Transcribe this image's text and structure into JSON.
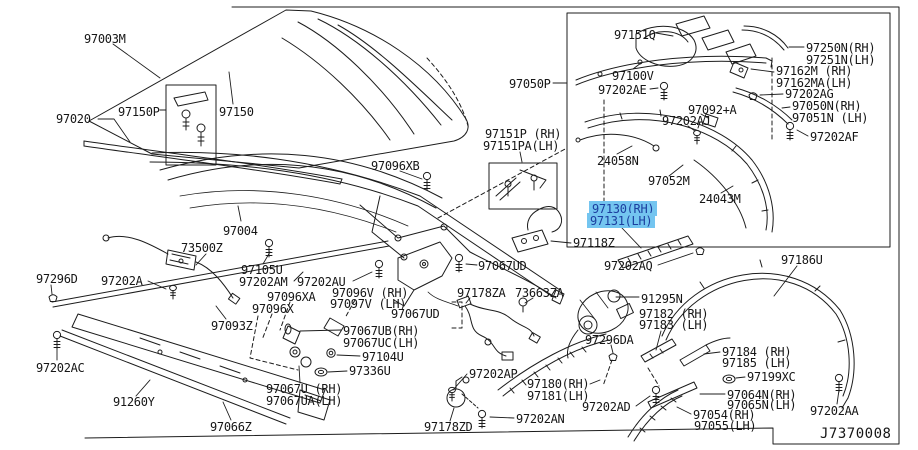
{
  "page": {
    "bg": "#ffffff",
    "line_color": "#1c1c1c",
    "highlight_bg": "#74c5f0",
    "highlight_text": "#1c3f9f",
    "diagram_code": "J7370008"
  },
  "labels": [
    {
      "text": "97003M",
      "x": 84,
      "y": 33
    },
    {
      "text": "97020",
      "x": 56,
      "y": 113
    },
    {
      "text": "97150P",
      "x": 118,
      "y": 106
    },
    {
      "text": "97150",
      "x": 219,
      "y": 106
    },
    {
      "text": "97096XB",
      "x": 371,
      "y": 160
    },
    {
      "text": "97050P",
      "x": 509,
      "y": 78
    },
    {
      "text": "97151P (RH)",
      "x": 485,
      "y": 128
    },
    {
      "text": "97151PA(LH)",
      "x": 483,
      "y": 140
    },
    {
      "text": "97004",
      "x": 223,
      "y": 225
    },
    {
      "text": "73500Z",
      "x": 181,
      "y": 242
    },
    {
      "text": "97105U",
      "x": 241,
      "y": 264
    },
    {
      "text": "97202AM",
      "x": 239,
      "y": 276
    },
    {
      "text": "97202AU",
      "x": 297,
      "y": 276
    },
    {
      "text": "97296D",
      "x": 36,
      "y": 273
    },
    {
      "text": "97202A",
      "x": 101,
      "y": 275
    },
    {
      "text": "97093Z",
      "x": 211,
      "y": 320
    },
    {
      "text": "97202AC",
      "x": 36,
      "y": 362
    },
    {
      "text": "91260Y",
      "x": 113,
      "y": 396
    },
    {
      "text": "97066Z",
      "x": 210,
      "y": 421
    },
    {
      "text": "97096XA",
      "x": 267,
      "y": 291
    },
    {
      "text": "97096X",
      "x": 252,
      "y": 303
    },
    {
      "text": "97096V (RH)",
      "x": 332,
      "y": 287
    },
    {
      "text": "97097V (LH)",
      "x": 330,
      "y": 298
    },
    {
      "text": "97067UD",
      "x": 478,
      "y": 260
    },
    {
      "text": "97067UD",
      "x": 391,
      "y": 308
    },
    {
      "text": "97067UB(RH)",
      "x": 343,
      "y": 325
    },
    {
      "text": "97067UC(LH)",
      "x": 343,
      "y": 337
    },
    {
      "text": "97104U",
      "x": 362,
      "y": 351
    },
    {
      "text": "97336U",
      "x": 349,
      "y": 365
    },
    {
      "text": "97067U (RH)",
      "x": 266,
      "y": 383
    },
    {
      "text": "97067UA(LH)",
      "x": 266,
      "y": 395
    },
    {
      "text": "97178ZA",
      "x": 457,
      "y": 287
    },
    {
      "text": "73663ZA",
      "x": 515,
      "y": 287
    },
    {
      "text": "97202AP",
      "x": 469,
      "y": 368
    },
    {
      "text": "97178ZD",
      "x": 424,
      "y": 421
    },
    {
      "text": "97202AN",
      "x": 516,
      "y": 413
    },
    {
      "text": "97180(RH)",
      "x": 527,
      "y": 378
    },
    {
      "text": "97181(LH)",
      "x": 527,
      "y": 390
    },
    {
      "text": "97202AD",
      "x": 582,
      "y": 401
    },
    {
      "text": "97296DA",
      "x": 585,
      "y": 334
    },
    {
      "text": "91295N",
      "x": 641,
      "y": 293
    },
    {
      "text": "97182 (RH)",
      "x": 639,
      "y": 308
    },
    {
      "text": "97183 (LH)",
      "x": 639,
      "y": 319
    },
    {
      "text": "97184 (RH)",
      "x": 722,
      "y": 346
    },
    {
      "text": "97185 (LH)",
      "x": 722,
      "y": 357
    },
    {
      "text": "97199XC",
      "x": 747,
      "y": 371
    },
    {
      "text": "97064N(RH)",
      "x": 727,
      "y": 389
    },
    {
      "text": "97065N(LH)",
      "x": 727,
      "y": 399
    },
    {
      "text": "97054(RH)",
      "x": 693,
      "y": 409
    },
    {
      "text": "97055(LH)",
      "x": 694,
      "y": 420
    },
    {
      "text": "97202AA",
      "x": 810,
      "y": 405
    },
    {
      "text": "97186U",
      "x": 781,
      "y": 254
    },
    {
      "text": "97130(RH)",
      "x": 592,
      "y": 203,
      "hl": true
    },
    {
      "text": "97131(LH)",
      "x": 590,
      "y": 215,
      "hl": true
    },
    {
      "text": "97118Z",
      "x": 573,
      "y": 237
    },
    {
      "text": "97202AQ",
      "x": 604,
      "y": 260
    },
    {
      "text": "97151Q",
      "x": 614,
      "y": 29
    },
    {
      "text": "97100V",
      "x": 612,
      "y": 70
    },
    {
      "text": "97202AE",
      "x": 598,
      "y": 84
    },
    {
      "text": "97250N(RH)",
      "x": 806,
      "y": 42
    },
    {
      "text": "97251N(LH)",
      "x": 806,
      "y": 54
    },
    {
      "text": "97162M (RH)",
      "x": 776,
      "y": 65
    },
    {
      "text": "97162MA(LH)",
      "x": 776,
      "y": 77
    },
    {
      "text": "97202AG",
      "x": 785,
      "y": 88
    },
    {
      "text": "97050N(RH)",
      "x": 792,
      "y": 100
    },
    {
      "text": "97051N (LH)",
      "x": 792,
      "y": 112
    },
    {
      "text": "97092+A",
      "x": 688,
      "y": 104
    },
    {
      "text": "97202AJ",
      "x": 662,
      "y": 115
    },
    {
      "text": "97202AF",
      "x": 810,
      "y": 131
    },
    {
      "text": "24058N",
      "x": 597,
      "y": 155
    },
    {
      "text": "97052M",
      "x": 648,
      "y": 175
    },
    {
      "text": "24043M",
      "x": 699,
      "y": 193
    }
  ]
}
